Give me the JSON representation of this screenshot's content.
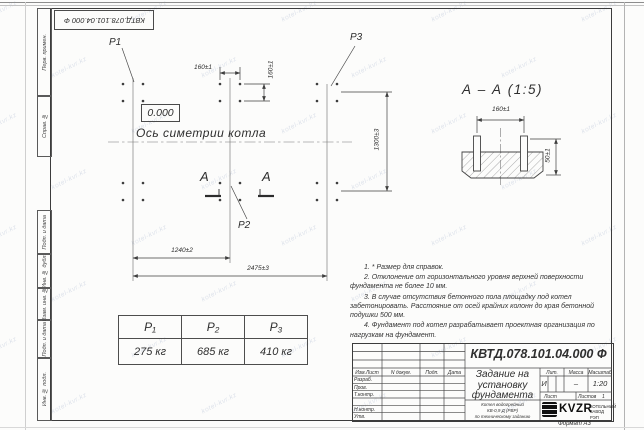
{
  "watermark": {
    "text": "kotel-kvr.kz"
  },
  "frame": {
    "top_stamp": "КВТД.078.101.04.000 Ф",
    "left_columns": [
      "Перв. примен.",
      "Справ. №",
      "Подп. и дата",
      "Инв. № дубл.",
      "Взам. инв. №",
      "Подп. и дата",
      "Инв. № подл."
    ],
    "format_label": "Формат А3"
  },
  "plan": {
    "p1_label": "P1",
    "p2_label": "P2",
    "p3_label": "P3",
    "elevation": "0.000",
    "axis_label": "Ось симетрии котла",
    "dim_160_h": "160±1",
    "dim_160_v": "160±1",
    "dim_1300": "1300±3",
    "dim_1240": "1240±2",
    "dim_2475": "2475±3",
    "section_letter_left": "А",
    "section_letter_right": "А"
  },
  "section_view": {
    "title": "А – А (1:5)",
    "dim_160": "160±1",
    "dim_50": "50±1"
  },
  "loads_table": {
    "headers": [
      "P₁",
      "P₂",
      "P₃"
    ],
    "values": [
      "275  кг",
      "685  кг",
      "410  кг"
    ]
  },
  "notes": [
    "1. * Размер для справок.",
    "2. Отклонение от горизонтального уровня верхней поверхности фундамента не более 10 мм.",
    "3. В случае отсутствия бетонного пола площадку под котел забетонировать. Расстояние от осей крайних колонн до края бетонной подушки 500 мм.",
    "4. Фундамент под котел разрабатывает проектная организация по нагрузкам на фундамент."
  ],
  "title_block": {
    "doc_number": "КВТД.078.101.04.000 Ф",
    "title": "Задание на установку фундамента",
    "subtitle_lines": [
      "Котел водогрейный",
      "КВ-0,9 Д (РВР)",
      "по техническому заданию"
    ],
    "header_row": [
      "Изм.Лист",
      "N докум.",
      "Подп.",
      "Дата"
    ],
    "row_labels": [
      "Разраб.",
      "Пров.",
      "Т.контр.",
      "Н.контр.",
      "Утв."
    ],
    "lit_label": "Лит.",
    "mass_label": "Масса",
    "scale_label": "Масштаб",
    "lit_value": "И",
    "mass_value": "–",
    "scale_value": "1:20",
    "sheet_label": "Лист",
    "sheets_label": "Листов",
    "sheets_value": "1",
    "company": "KVZR",
    "company_full": "КОТЕЛЬНЫЙ ЗАВОД РЭП"
  }
}
